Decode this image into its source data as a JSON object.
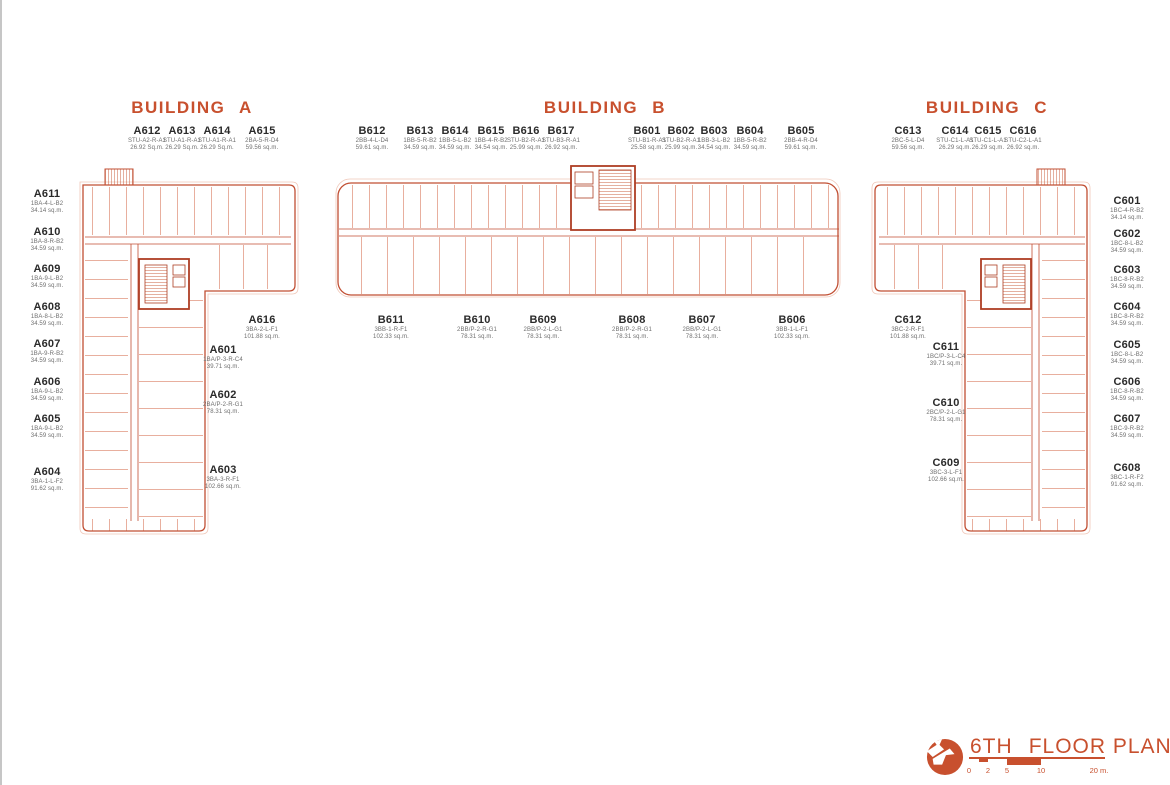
{
  "buildings": {
    "a": {
      "name": "BUILDING A",
      "top_units": [
        {
          "id": "A612",
          "type": "STU-A2-R-A1",
          "area": "26.92 Sq.m."
        },
        {
          "id": "A613",
          "type": "STU-A1-R-A1",
          "area": "26.29 Sq.m."
        },
        {
          "id": "A614",
          "type": "STU-A1-R-A1",
          "area": "26.29 Sq.m."
        },
        {
          "id": "A615",
          "type": "2BA-5-R-D4",
          "area": "59.56 sq.m."
        }
      ],
      "left_units": [
        {
          "id": "A611",
          "type": "1BA-4-L-B2",
          "area": "34.14 sq.m."
        },
        {
          "id": "A610",
          "type": "1BA-8-R-B2",
          "area": "34.59 sq.m."
        },
        {
          "id": "A609",
          "type": "1BA-9-L-B2",
          "area": "34.59 sq.m."
        },
        {
          "id": "A608",
          "type": "1BA-8-L-B2",
          "area": "34.59 sq.m."
        },
        {
          "id": "A607",
          "type": "1BA-9-R-B2",
          "area": "34.59 sq.m."
        },
        {
          "id": "A606",
          "type": "1BA-9-L-B2",
          "area": "34.59 sq.m."
        },
        {
          "id": "A605",
          "type": "1BA-9-L-B2",
          "area": "34.59 sq.m."
        },
        {
          "id": "A604",
          "type": "3BA-1-L-F2",
          "area": "91.62 sq.m."
        }
      ],
      "inner_units": [
        {
          "id": "A616",
          "type": "3BA-2-L-F1",
          "area": "101.88 sq.m."
        },
        {
          "id": "A601",
          "type": "1BA/P-3-R-C4",
          "area": "39.71 sq.m."
        },
        {
          "id": "A602",
          "type": "2BA/P-2-R-G1",
          "area": "78.31 sq.m."
        },
        {
          "id": "A603",
          "type": "3BA-3-R-F1",
          "area": "102.66 sq.m."
        }
      ]
    },
    "b": {
      "name": "BUILDING B",
      "top_left_units": [
        {
          "id": "B612",
          "type": "2BB-4-L-D4",
          "area": "59.61 sq.m."
        },
        {
          "id": "B613",
          "type": "1BB-5-R-B2",
          "area": "34.59 sq.m."
        },
        {
          "id": "B614",
          "type": "1BB-5-L-B2",
          "area": "34.59 sq.m."
        },
        {
          "id": "B615",
          "type": "1BB-4-R-B2",
          "area": "34.54 sq.m."
        },
        {
          "id": "B616",
          "type": "STU-B2-R-A1",
          "area": "25.99 sq.m."
        },
        {
          "id": "B617",
          "type": "STU-B3-R-A1",
          "area": "26.92 sq.m."
        }
      ],
      "top_right_units": [
        {
          "id": "B601",
          "type": "STU-B1-R-A1",
          "area": "25.58 sq.m."
        },
        {
          "id": "B602",
          "type": "STU-B2-R-A1",
          "area": "25.99 sq.m."
        },
        {
          "id": "B603",
          "type": "1BB-3-L-B2",
          "area": "34.54 sq.m."
        },
        {
          "id": "B604",
          "type": "1BB-5-R-B2",
          "area": "34.59 sq.m."
        },
        {
          "id": "B605",
          "type": "2BB-4-R-D4",
          "area": "59.61 sq.m."
        }
      ],
      "bottom_units": [
        {
          "id": "B611",
          "type": "3BB-1-R-F1",
          "area": "102.33 sq.m."
        },
        {
          "id": "B610",
          "type": "2BB/P-2-R-G1",
          "area": "78.31 sq.m."
        },
        {
          "id": "B609",
          "type": "2BB/P-2-L-G1",
          "area": "78.31 sq.m."
        },
        {
          "id": "B608",
          "type": "2BB/P-2-R-G1",
          "area": "78.31 sq.m."
        },
        {
          "id": "B607",
          "type": "2BB/P-2-L-G1",
          "area": "78.31 sq.m."
        },
        {
          "id": "B606",
          "type": "3BB-1-L-F1",
          "area": "102.33 sq.m."
        }
      ]
    },
    "c": {
      "name": "BUILDING C",
      "top_units": [
        {
          "id": "C613",
          "type": "2BC-5-L-D4",
          "area": "59.56 sq.m."
        },
        {
          "id": "C614",
          "type": "STU-C1-L-A1",
          "area": "26.29 sq.m."
        },
        {
          "id": "C615",
          "type": "STU-C1-L-A1",
          "area": "26.29 sq.m."
        },
        {
          "id": "C616",
          "type": "STU-C2-L-A1",
          "area": "26.92 sq.m."
        }
      ],
      "right_units": [
        {
          "id": "C601",
          "type": "1BC-4-R-B2",
          "area": "34.14 sq.m."
        },
        {
          "id": "C602",
          "type": "1BC-8-L-B2",
          "area": "34.59 sq.m."
        },
        {
          "id": "C603",
          "type": "1BC-8-R-B2",
          "area": "34.59 sq.m."
        },
        {
          "id": "C604",
          "type": "1BC-8-R-B2",
          "area": "34.59 sq.m."
        },
        {
          "id": "C605",
          "type": "1BC-8-L-B2",
          "area": "34.59 sq.m."
        },
        {
          "id": "C606",
          "type": "1BC-8-R-B2",
          "area": "34.59 sq.m."
        },
        {
          "id": "C607",
          "type": "1BC-9-R-B2",
          "area": "34.59 sq.m."
        },
        {
          "id": "C608",
          "type": "3BC-1-R-F2",
          "area": "91.62 sq.m."
        }
      ],
      "inner_units": [
        {
          "id": "C612",
          "type": "3BC-2-R-F1",
          "area": "101.88 sq.m."
        },
        {
          "id": "C611",
          "type": "1BC/P-3-L-C4",
          "area": "39.71 sq.m."
        },
        {
          "id": "C610",
          "type": "2BC/P-2-L-G1",
          "area": "78.31 sq.m."
        },
        {
          "id": "C609",
          "type": "3BC-3-L-F1",
          "area": "102.66 sq.m."
        }
      ]
    }
  },
  "footer": {
    "floor": "6TH",
    "title": "FLOOR PLAN",
    "scale_ticks": [
      "0",
      "2",
      "5",
      "10",
      "20 m."
    ]
  },
  "colors": {
    "accent": "#C8502E",
    "plan_wall": "#C14F33",
    "plan_partition": "#E29B86",
    "label_dark": "#2B2B2B",
    "label_gray": "#6F6F6F"
  }
}
